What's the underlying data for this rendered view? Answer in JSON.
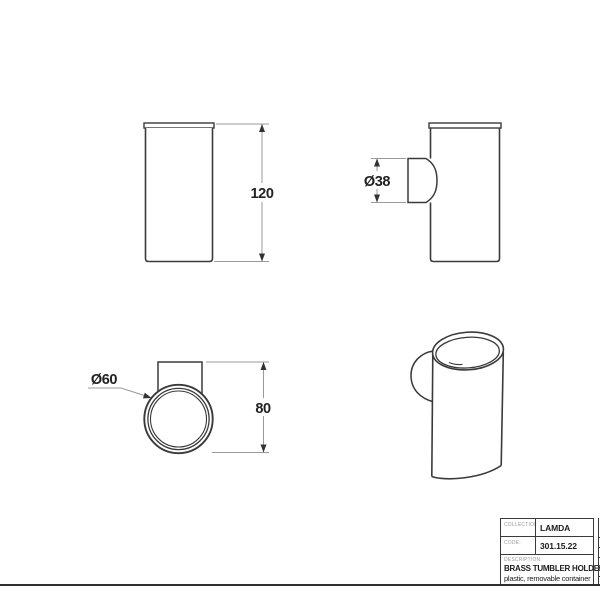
{
  "drawing": {
    "front_view": {
      "height_dim": "120"
    },
    "side_view": {
      "bracket_dim": "Ø38"
    },
    "top_view": {
      "diameter_dim": "Ø60",
      "depth_dim": "80"
    }
  },
  "title_block": {
    "collection_label": "COLLECTION:",
    "collection_value": "LAMDA",
    "code_label": "CODE:",
    "code_value": "301.15.22",
    "description_label": "DESCRIPTION:",
    "description_line1": "BRASS TUMBLER HOLDER",
    "description_line2": "plastic, removable container"
  },
  "colors": {
    "object_line": "#3a3a3a",
    "dimension_line": "#9a9a9a",
    "dimension_text": "#222222",
    "label_gray": "#9b9b9b",
    "frame_line": "#2f2f2f",
    "background": "#ffffff"
  }
}
